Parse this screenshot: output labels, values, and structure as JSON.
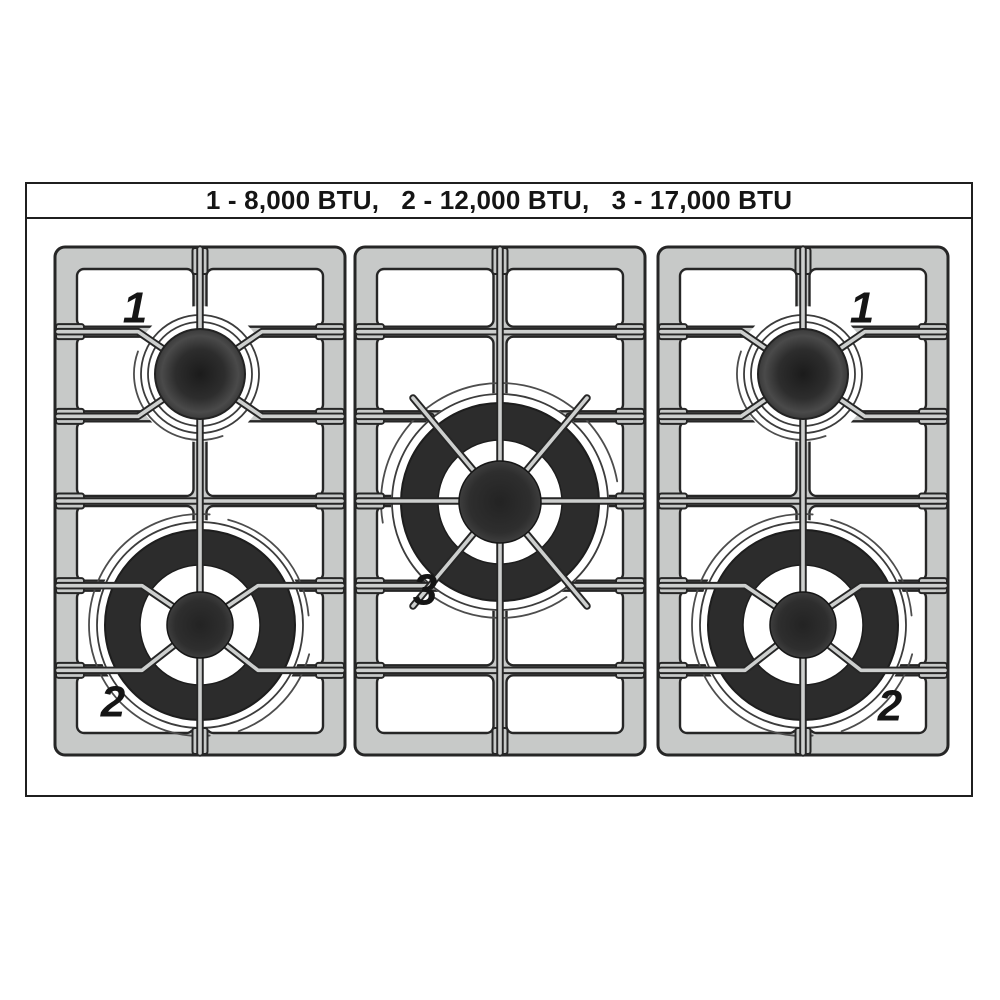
{
  "legend_bar": {
    "text": "1 - 8,000 BTU,   2 - 12,000 BTU,   3 - 17,000 BTU"
  },
  "ratings": [
    {
      "burner": "1",
      "btu": "8,000 BTU"
    },
    {
      "burner": "2",
      "btu": "12,000 BTU"
    },
    {
      "burner": "3",
      "btu": "17,000 BTU"
    }
  ],
  "cooktop": {
    "sections": [
      {
        "id": "left",
        "burners": [
          {
            "label": "1",
            "size": "small",
            "position": "top",
            "label_side": "left"
          },
          {
            "label": "2",
            "size": "large",
            "position": "bottom",
            "label_side": "left"
          }
        ]
      },
      {
        "id": "center",
        "burners": [
          {
            "label": "3",
            "size": "xlarge",
            "position": "middle",
            "label_side": "left"
          }
        ]
      },
      {
        "id": "right",
        "burners": [
          {
            "label": "1",
            "size": "small",
            "position": "top",
            "label_side": "right"
          },
          {
            "label": "2",
            "size": "large",
            "position": "bottom",
            "label_side": "right"
          }
        ]
      }
    ]
  },
  "colors": {
    "background": "#ffffff",
    "outline": "#262626",
    "frame_line": "#1f1f1f",
    "grate_gray": "#c7c9c8",
    "bar_gray": "#cdcfce",
    "burner_dark": "#2c2c2c",
    "ring_line": "#3c3c3c",
    "text": "#151515"
  }
}
